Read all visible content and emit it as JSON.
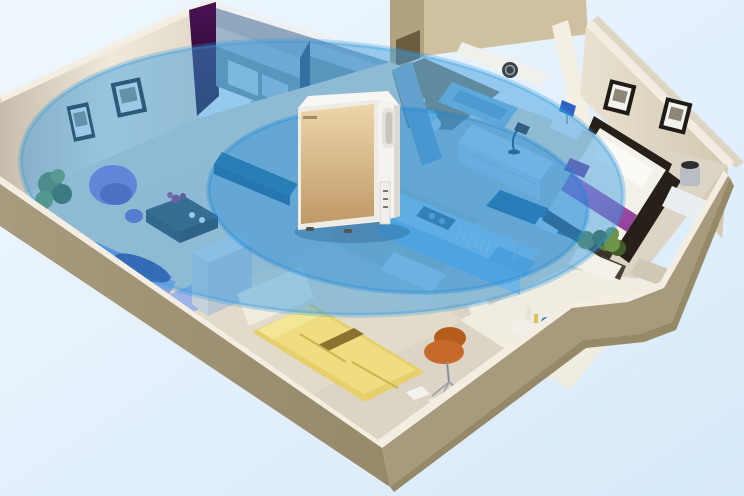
{
  "scene": {
    "subject": "air purifier placed in the middle of an apartment with circular clean-air coverage zones",
    "style": "isometric 3D cutaway floor plan render",
    "rooms": [
      "living room",
      "hallway",
      "bathroom",
      "master bedroom",
      "kitchen",
      "second bedroom",
      "entry"
    ],
    "furniture": {
      "living_room": [
        "blue sofa",
        "purple tub armchair",
        "dark coffee table with flowers",
        "potted plant",
        "two framed pictures"
      ],
      "hallway": [
        "storage closets"
      ],
      "bathroom": [
        "toilet",
        "bathtub",
        "washing machine under counter"
      ],
      "master_bedroom": [
        "double bed with purple runner",
        "glass nightstands",
        "table lamps",
        "white dresser with desk lamp",
        "two framed pictures",
        "floor plant"
      ],
      "kitchen": [
        "counter with stove and sink",
        "teal bar counter"
      ],
      "second_bedroom": [
        "yellow single bed",
        "orange designer chair",
        "papers on floor"
      ],
      "entry": [
        "planter box with shrubs",
        "tray with bottles",
        "doormat"
      ]
    },
    "device": {
      "type": "air purifier",
      "finish": "champagne gold front, white body",
      "logo_text_visible": false
    }
  },
  "coverage": {
    "zones": [
      "outer clean-air ellipse",
      "inner clean-air ellipse"
    ],
    "accent_color": "#3b9de2"
  },
  "palette": {
    "bg_top": "#eff7fd",
    "bg_bottom": "#d7eafa",
    "front_wall_tan": "#a89a7d",
    "front_wall_tan_dark": "#968968",
    "wall_rim_white": "#f3eee1",
    "west_wall_light": "#f0e9da",
    "west_wall_shadow": "#c6bcab",
    "accent_purple": "#4a1253",
    "accent_purple_dark": "#1f0726",
    "bedroom_wall": "#eae2d1",
    "bedroom_wall_shadow": "#d2c8b1",
    "bath_wall": "#cfc19f",
    "bath_wall_dark": "#b1a37e",
    "bath_nook_dark": "#6b5b3f",
    "floor_base": "#dcd5c5",
    "floor_bath_dark": "#837a5e",
    "floor_entry": "#efece1",
    "hall_wall_blue": "#8fa6bc",
    "hall_wall_blue_dark": "#74919c",
    "hall_panel_navy": "#2e4a68",
    "coverage_blue": "#3b9de2",
    "coverage_blue_deep": "#1583d6",
    "purifier_gold_light": "#ecd6aa",
    "purifier_gold_dark": "#c09967",
    "purifier_white": "#f4f3ef",
    "purifier_side_shadow": "#dbd8d1",
    "sofa_blue": "#8aa4e2",
    "sofa_back_blue": "#7490d8",
    "sofa_pillow_navy": "#2c3f90",
    "armchair_purple": "#8471d2",
    "coffee_table_dark": "#33414b",
    "flower_magenta": "#93306a",
    "plant_green": "#5d7f3d",
    "plant_green_dark": "#3f5c2a",
    "bed_frame_dark": "#262019",
    "bedding_white": "#f3f1ea",
    "runner_purple": "#ae53b6",
    "bed2_yellow": "#e7d06c",
    "bed2_yellow_light": "#f0dc81",
    "bed2_stripe": "#8a7330",
    "chair_orange": "#c8692c",
    "counter_top_blue": "#cfe7f6",
    "counter_front_blue": "#9ccbea",
    "bar_teal": "#2a5a78",
    "cabinet_teal": "#2f5e74",
    "sink_blue": "#8fc0e4",
    "tub_blue": "#7fb0d4",
    "lamp_blue": "#2f5fc0",
    "lamp_silver": "#b9bec4",
    "glass_white": "#e9eef2",
    "rug": "#d9d4c9",
    "headwall_white": "#f0ece0",
    "purple_stool": "#7a3f9a"
  }
}
